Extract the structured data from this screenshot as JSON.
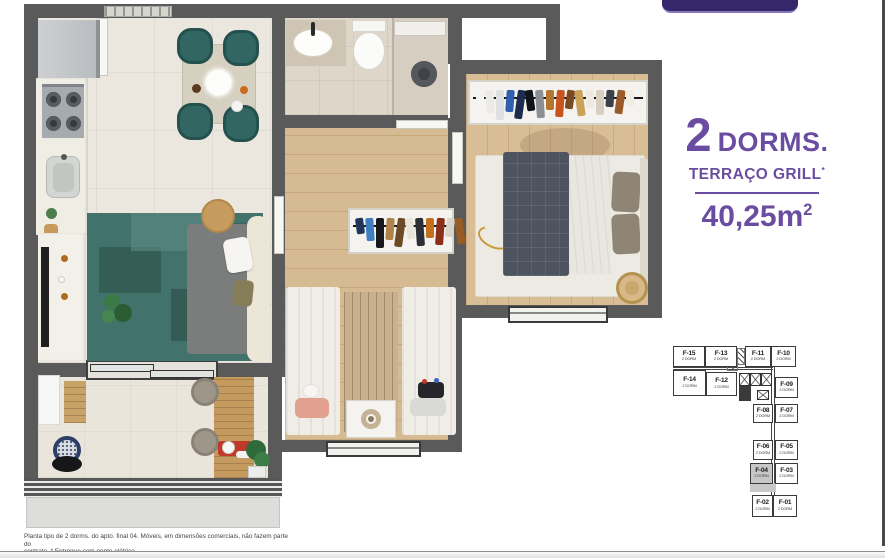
{
  "info_panel": {
    "dorms_number": "2",
    "dorms_label": "DORMS.",
    "feature_label": "TERRAÇO GRILL",
    "feature_mark": "*",
    "area_value": "40,25m",
    "area_sup": "2",
    "accent_color": "#6a4da0"
  },
  "caption": {
    "line1": "Planta tipo de 2 dorms. do apto. final 04. Móveis, em dimensões comerciais, não fazem parte do",
    "line2": "contrato. * Entregue com ponto elétrico"
  },
  "keyplan": {
    "highlight_color": "#c7c7c7",
    "units": [
      {
        "id": "F-15",
        "sub": "2 DORM",
        "x": 8,
        "y": 4,
        "w": 32,
        "h": 21,
        "hl": false
      },
      {
        "id": "F-13",
        "sub": "2 DORM",
        "x": 40,
        "y": 4,
        "w": 32,
        "h": 21,
        "hl": false
      },
      {
        "id": "F-11",
        "sub": "2 DORM",
        "x": 80,
        "y": 4,
        "w": 26,
        "h": 21,
        "hl": false
      },
      {
        "id": "F-10",
        "sub": "2 DORM",
        "x": 106,
        "y": 4,
        "w": 25,
        "h": 21,
        "hl": false
      },
      {
        "id": "F-14",
        "sub": "2 DORM",
        "x": 8,
        "y": 28,
        "w": 33,
        "h": 26,
        "hl": false
      },
      {
        "id": "F-12",
        "sub": "2 DORM",
        "x": 41,
        "y": 30,
        "w": 31,
        "h": 24,
        "hl": false
      },
      {
        "id": "F-09",
        "sub": "2 DORM",
        "x": 110,
        "y": 35,
        "w": 23,
        "h": 21,
        "hl": false
      },
      {
        "id": "F-08",
        "sub": "2 DORM",
        "x": 88,
        "y": 62,
        "w": 20,
        "h": 19,
        "hl": false
      },
      {
        "id": "F-07",
        "sub": "2 DORM",
        "x": 110,
        "y": 62,
        "w": 23,
        "h": 19,
        "hl": false
      },
      {
        "id": "F-06",
        "sub": "2 DORM",
        "x": 88,
        "y": 98,
        "w": 20,
        "h": 20,
        "hl": false
      },
      {
        "id": "F-05",
        "sub": "2 DORM",
        "x": 110,
        "y": 98,
        "w": 23,
        "h": 20,
        "hl": false
      },
      {
        "id": "F-04",
        "sub": "2 DORM",
        "x": 85,
        "y": 121,
        "w": 23,
        "h": 21,
        "hl": true
      },
      {
        "id": "F-03",
        "sub": "2 DORM",
        "x": 110,
        "y": 121,
        "w": 23,
        "h": 21,
        "hl": false
      },
      {
        "id": "F-02",
        "sub": "2 DORM",
        "x": 87,
        "y": 153,
        "w": 21,
        "h": 22,
        "hl": false
      },
      {
        "id": "F-01",
        "sub": "2 DORM",
        "x": 108,
        "y": 153,
        "w": 24,
        "h": 22,
        "hl": false
      }
    ]
  },
  "racks": {
    "bedroom1": [
      "#f4f4f2",
      "#eceae6",
      "#dfe0e2",
      "#2f5fae",
      "#1d2c4e",
      "#111418",
      "#8c8f96",
      "#b4762f",
      "#c8541f",
      "#7a4a22",
      "#caa25a",
      "#efe9df",
      "#d9cfc0",
      "#3b3f46",
      "#9c5a28",
      "#f1ede4"
    ],
    "bedroom2": [
      "#20355c",
      "#3f7fc1",
      "#16181c",
      "#b08448",
      "#6d4a26",
      "#e8e4da",
      "#2c3036",
      "#c2701e",
      "#8a2f1a",
      "#d9d4c8",
      "#995c24"
    ]
  }
}
